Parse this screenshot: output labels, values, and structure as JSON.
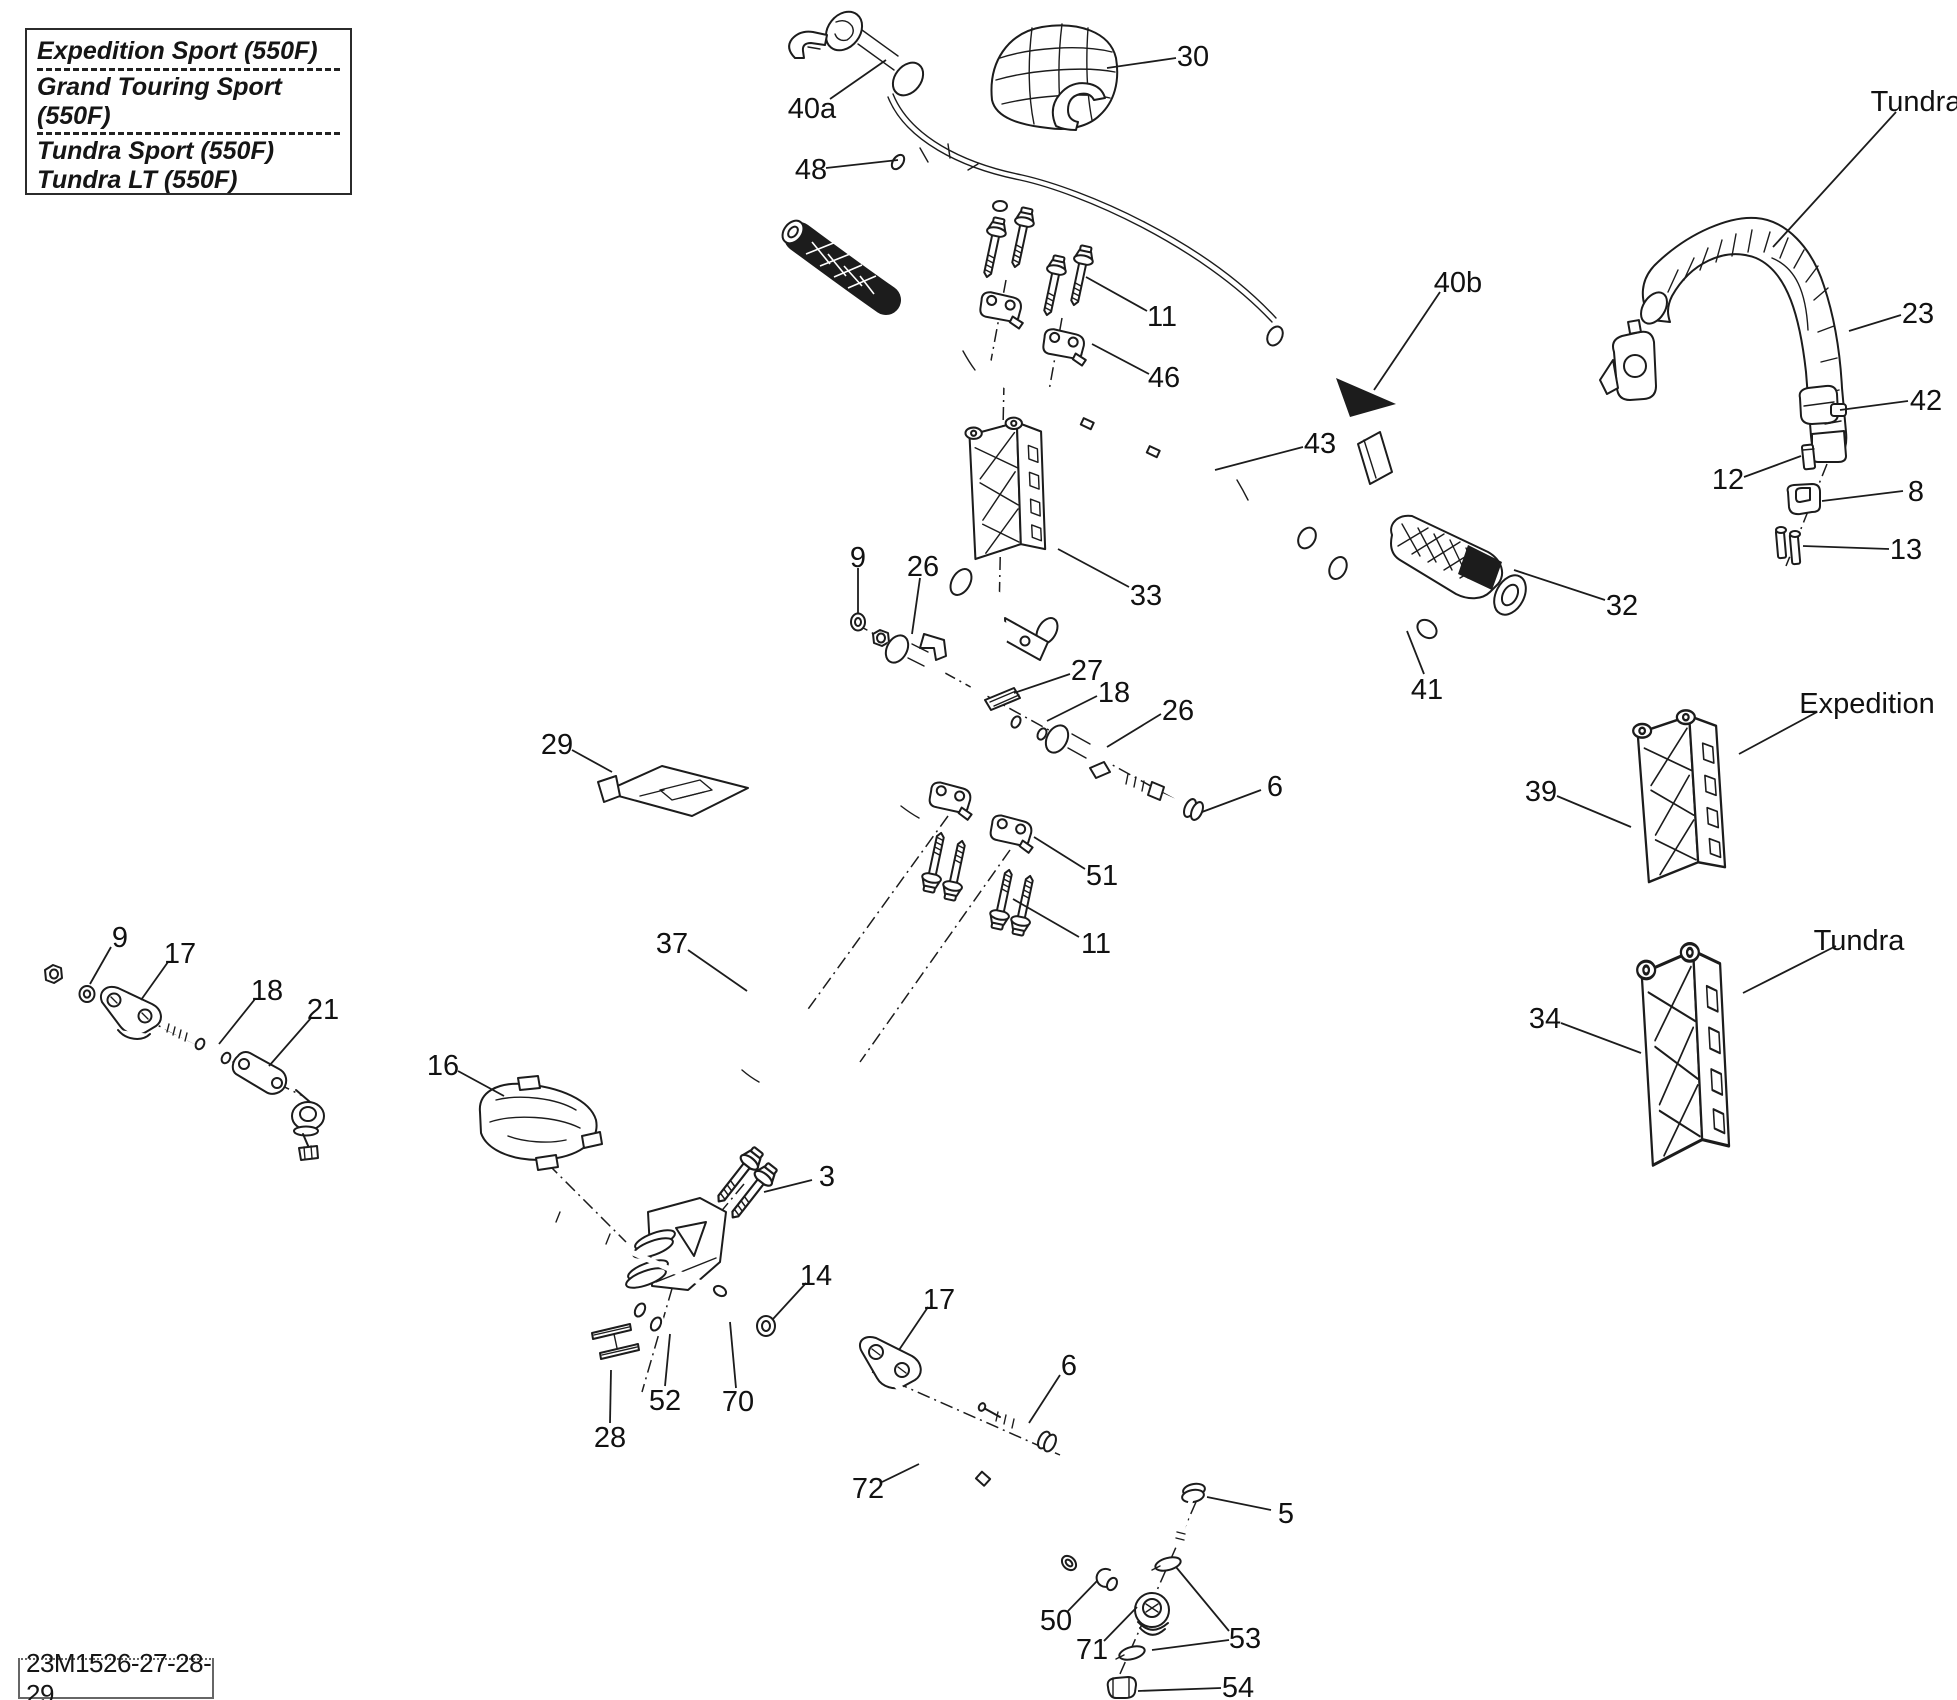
{
  "page": {
    "background": "#ffffff",
    "ink": "#1c1c1c",
    "width": 1957,
    "height": 1700
  },
  "model_box": {
    "lines": [
      "Expedition Sport (550F)",
      "Grand Touring Sport (550F)",
      "Tundra Sport (550F)",
      "Tundra LT (550F)"
    ]
  },
  "drawing_code": "23M1526-27-28-29",
  "callouts": [
    {
      "label": "40a",
      "x": 812,
      "y": 107,
      "leaders": [
        [
          830,
          99,
          886,
          60
        ]
      ]
    },
    {
      "label": "30",
      "x": 1193,
      "y": 55,
      "leaders": [
        [
          1176,
          58,
          1107,
          68
        ]
      ]
    },
    {
      "label": "48",
      "x": 811,
      "y": 168,
      "leaders": [
        [
          826,
          168,
          898,
          160
        ]
      ]
    },
    {
      "label": "Tundra",
      "x": 1916,
      "y": 100,
      "leaders": [
        [
          1896,
          112,
          1773,
          247
        ]
      ]
    },
    {
      "label": "23",
      "x": 1918,
      "y": 312,
      "leaders": [
        [
          1901,
          315,
          1849,
          331
        ]
      ]
    },
    {
      "label": "11",
      "x": 1162,
      "y": 315,
      "leaders": [
        [
          1147,
          311,
          1086,
          277
        ]
      ]
    },
    {
      "label": "46",
      "x": 1164,
      "y": 376,
      "leaders": [
        [
          1149,
          374,
          1092,
          344
        ]
      ]
    },
    {
      "label": "40b",
      "x": 1458,
      "y": 281,
      "leaders": [
        [
          1440,
          292,
          1374,
          390
        ]
      ]
    },
    {
      "label": "43",
      "x": 1320,
      "y": 442,
      "leaders": [
        [
          1303,
          447,
          1215,
          470
        ]
      ]
    },
    {
      "label": "42",
      "x": 1926,
      "y": 399,
      "leaders": [
        [
          1908,
          401,
          1840,
          410
        ]
      ]
    },
    {
      "label": "12",
      "x": 1728,
      "y": 478,
      "leaders": [
        [
          1744,
          477,
          1801,
          456
        ]
      ]
    },
    {
      "label": "8",
      "x": 1916,
      "y": 490,
      "leaders": [
        [
          1903,
          491,
          1822,
          501
        ]
      ]
    },
    {
      "label": "13",
      "x": 1906,
      "y": 548,
      "leaders": [
        [
          1889,
          549,
          1803,
          546
        ]
      ]
    },
    {
      "label": "32",
      "x": 1622,
      "y": 604,
      "leaders": [
        [
          1605,
          600,
          1514,
          570
        ]
      ]
    },
    {
      "label": "33",
      "x": 1146,
      "y": 594,
      "leaders": [
        [
          1129,
          587,
          1058,
          549
        ]
      ]
    },
    {
      "label": "41",
      "x": 1427,
      "y": 688,
      "leaders": [
        [
          1424,
          674,
          1407,
          631
        ]
      ]
    },
    {
      "label": "9",
      "x": 858,
      "y": 556,
      "leaders": [
        [
          858,
          568,
          858,
          613
        ]
      ]
    },
    {
      "label": "26",
      "x": 923,
      "y": 565,
      "leaders": [
        [
          920,
          578,
          912,
          634
        ]
      ]
    },
    {
      "label": "27",
      "x": 1087,
      "y": 669,
      "leaders": [
        [
          1070,
          674,
          1014,
          693
        ]
      ]
    },
    {
      "label": "18",
      "x": 1114,
      "y": 691,
      "leaders": [
        [
          1097,
          696,
          1047,
          721
        ]
      ]
    },
    {
      "label": "26",
      "x": 1178,
      "y": 709,
      "leaders": [
        [
          1161,
          714,
          1107,
          747
        ]
      ]
    },
    {
      "label": "6",
      "x": 1275,
      "y": 785,
      "leaders": [
        [
          1261,
          790,
          1202,
          812
        ]
      ]
    },
    {
      "label": "51",
      "x": 1102,
      "y": 874,
      "leaders": [
        [
          1085,
          869,
          1034,
          837
        ]
      ]
    },
    {
      "label": "11",
      "x": 1096,
      "y": 942,
      "leaders": [
        [
          1079,
          937,
          1013,
          899
        ]
      ]
    },
    {
      "label": "29",
      "x": 557,
      "y": 743,
      "leaders": [
        [
          572,
          750,
          612,
          772
        ]
      ]
    },
    {
      "label": "37",
      "x": 672,
      "y": 942,
      "leaders": [
        [
          688,
          950,
          747,
          991
        ]
      ]
    },
    {
      "label": "Expedition",
      "x": 1867,
      "y": 702,
      "leaders": [
        [
          1817,
          712,
          1739,
          754
        ]
      ]
    },
    {
      "label": "39",
      "x": 1541,
      "y": 790,
      "leaders": [
        [
          1557,
          796,
          1631,
          827
        ]
      ]
    },
    {
      "label": "Tundra",
      "x": 1859,
      "y": 939,
      "leaders": [
        [
          1836,
          946,
          1743,
          993
        ]
      ]
    },
    {
      "label": "34",
      "x": 1545,
      "y": 1017,
      "leaders": [
        [
          1561,
          1023,
          1641,
          1053
        ]
      ]
    },
    {
      "label": "9",
      "x": 120,
      "y": 936,
      "leaders": [
        [
          111,
          947,
          90,
          984
        ]
      ]
    },
    {
      "label": "17",
      "x": 180,
      "y": 952,
      "leaders": [
        [
          168,
          962,
          141,
          1000
        ]
      ]
    },
    {
      "label": "18",
      "x": 267,
      "y": 989,
      "leaders": [
        [
          255,
          999,
          219,
          1044
        ]
      ]
    },
    {
      "label": "21",
      "x": 323,
      "y": 1008,
      "leaders": [
        [
          311,
          1018,
          269,
          1066
        ]
      ]
    },
    {
      "label": "16",
      "x": 443,
      "y": 1064,
      "leaders": [
        [
          458,
          1071,
          504,
          1096
        ]
      ]
    },
    {
      "label": "3",
      "x": 827,
      "y": 1175,
      "leaders": [
        [
          812,
          1180,
          764,
          1192
        ]
      ]
    },
    {
      "label": "14",
      "x": 816,
      "y": 1274,
      "leaders": [
        [
          806,
          1283,
          773,
          1319
        ]
      ]
    },
    {
      "label": "17",
      "x": 939,
      "y": 1298,
      "leaders": [
        [
          928,
          1307,
          899,
          1350
        ]
      ]
    },
    {
      "label": "52",
      "x": 665,
      "y": 1399,
      "leaders": [
        [
          665,
          1386,
          670,
          1334
        ]
      ]
    },
    {
      "label": "70",
      "x": 738,
      "y": 1400,
      "leaders": [
        [
          736,
          1388,
          730,
          1322
        ]
      ]
    },
    {
      "label": "28",
      "x": 610,
      "y": 1436,
      "leaders": [
        [
          610,
          1423,
          611,
          1370
        ]
      ]
    },
    {
      "label": "72",
      "x": 868,
      "y": 1487,
      "leaders": [
        [
          882,
          1482,
          919,
          1464
        ]
      ]
    },
    {
      "label": "6",
      "x": 1069,
      "y": 1364,
      "leaders": [
        [
          1060,
          1375,
          1029,
          1423
        ]
      ]
    },
    {
      "label": "5",
      "x": 1286,
      "y": 1512,
      "leaders": [
        [
          1271,
          1510,
          1207,
          1497
        ]
      ]
    },
    {
      "label": "50",
      "x": 1056,
      "y": 1619,
      "leaders": [
        [
          1068,
          1611,
          1097,
          1581
        ]
      ]
    },
    {
      "label": "71",
      "x": 1092,
      "y": 1648,
      "leaders": [
        [
          1104,
          1641,
          1137,
          1607
        ]
      ]
    },
    {
      "label": "53",
      "x": 1245,
      "y": 1637,
      "leaders": [
        [
          1229,
          1631,
          1176,
          1567
        ],
        [
          1229,
          1640,
          1152,
          1650
        ]
      ]
    },
    {
      "label": "54",
      "x": 1238,
      "y": 1686,
      "leaders": [
        [
          1221,
          1688,
          1138,
          1691
        ]
      ]
    }
  ]
}
